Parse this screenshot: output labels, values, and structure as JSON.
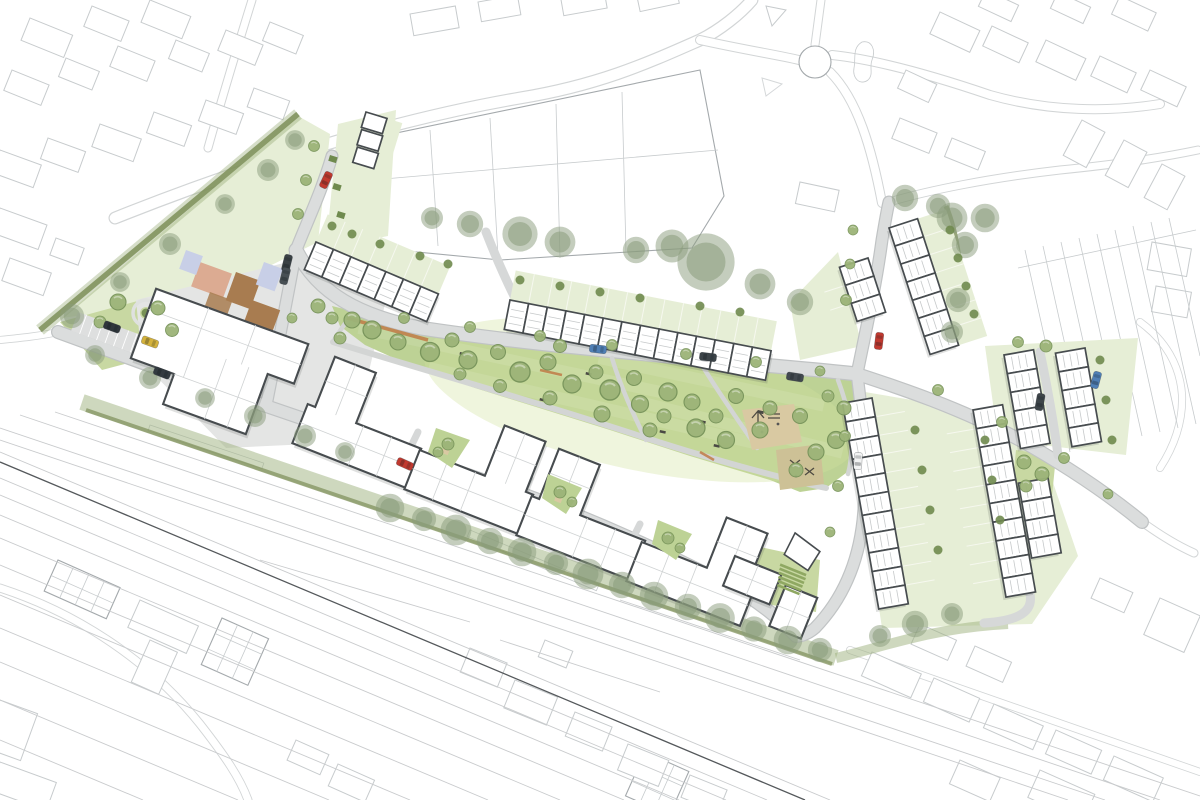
{
  "palette": {
    "ctxline": "#c7cbcd",
    "ctxdark": "#a4a9ac",
    "road": "#dbdddd",
    "roadedge": "#c0c3c4",
    "lane": "#d6d8d8",
    "path": "#d3d5d4",
    "lawn": "#c8d8a2",
    "park": "#bdd295",
    "garden": "#e6eed6",
    "gardenline": "#f6f8ef",
    "hedge": "#7d8f58",
    "tree": "#9cb478",
    "treeedge": "#77935a",
    "treedark": "#8a9c7c",
    "treesmall": "#6f8a4e",
    "bldstroke": "#474c4f",
    "bldinner": "#c6c9ca",
    "aptinner": "#cfd2d3",
    "salmon": "#dcab92",
    "brown": "#a87c50",
    "bluepatch": "#c8cfe7",
    "pinkpatch": "#ecd8d0",
    "sand": "#d9c9a2",
    "sand2": "#cdc196",
    "orange": "#bf7a45",
    "rail": "#c9cbcd",
    "raildark": "#54585b",
    "stripegreen": "#8fa862"
  },
  "icons": {
    "tree-icon": "circle-canopy",
    "existing-tree-icon": "soft-double-circle",
    "bush-icon": "small-circle",
    "car-icon": "rounded-rectangle-with-windows",
    "bench-icon": "small-dark-bar",
    "roundabout-icon": "circle-outline"
  },
  "scene": {
    "cars": [
      {
        "name": "car-red-access-street",
        "css": "color:#c0392f"
      },
      {
        "name": "car-red-northeast-street",
        "css": "color:#c0392f"
      },
      {
        "name": "car-red-courtyard",
        "css": "color:#c0392f"
      },
      {
        "name": "car-blue-main-street",
        "css": "color:#4f7fb5"
      },
      {
        "name": "car-blue-east-lane",
        "css": "color:#4f7fb5"
      },
      {
        "name": "car-dark-main-street",
        "css": "color:#3d4449"
      },
      {
        "name": "car-dark-junction",
        "css": "color:#42494f"
      },
      {
        "name": "car-dark-south-road",
        "css": "color:#333a40"
      },
      {
        "name": "car-dark-parking",
        "css": "color:#2f363b"
      },
      {
        "name": "car-yellow-parking",
        "css": "color:#d4b23c"
      },
      {
        "name": "car-white-southeast-street",
        "css": "color:#f2f3f3"
      },
      {
        "name": "car-dark-access-1",
        "css": "color:#3a4145"
      },
      {
        "name": "car-dark-access-2",
        "css": "color:#474f54"
      },
      {
        "name": "car-dark-fareast-lane",
        "css": "color:#3d4449"
      }
    ]
  }
}
